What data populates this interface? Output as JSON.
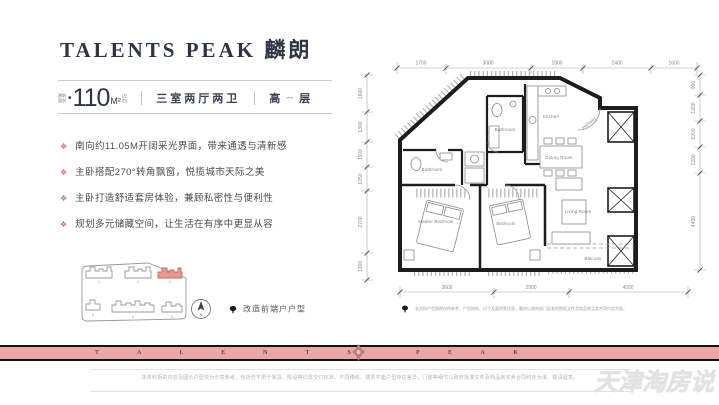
{
  "header": {
    "title": "TALENTS PEAK 麟朗"
  },
  "spec": {
    "area_label_top": "建筑",
    "area_label_bottom": "面积",
    "area_value": "110",
    "area_unit": "M²",
    "area_note_top": "(左",
    "area_note_bottom": "右)",
    "rooms": "三室两厅两卫",
    "floor_prefix": "高",
    "floor_dash": "⁓",
    "floor_suffix": "层"
  },
  "features": [
    "南向约11.05M开阔采光界面，带来通透与清新感",
    "主卧搭配270°转角飘窗，悦揽城市天际之美",
    "主卧打造舒适套房体验，兼顾私密性与便利性",
    "规划多元储藏空间，让生活在有序中更显从容"
  ],
  "siteplan": {
    "legend": "改造前端户户型",
    "compass": "N",
    "buildings": [
      "1",
      "2",
      "3",
      "4",
      "5",
      "6"
    ]
  },
  "floorplan": {
    "rooms": {
      "master": "Master Bedroom",
      "bedroom": "Bedroom",
      "living": "Living Room",
      "balcony": "Balcony",
      "kitchen": "Kitchen",
      "dining": "Dining Room",
      "hallway": "Hallway",
      "bath1": "Bathroom",
      "bath2": "Bathroom"
    },
    "dims_top": [
      "1700",
      "3000",
      "1800",
      "2400",
      "1600"
    ],
    "dims_bottom": [
      "3600",
      "2900",
      "4550"
    ],
    "dims_left": [
      "1600",
      "1300",
      "1100",
      "1050",
      "2700",
      "1200"
    ],
    "dims_right": [
      "900",
      "1200",
      "1200",
      "1200",
      "4450"
    ],
    "note": "本资料户型图例仅供参考，户型结构、尺寸及面积等信息，最终以政府部门批准的图纸文件及商品房买卖合同约定为准。"
  },
  "banner": {
    "letters_left": [
      "T",
      "A",
      "L",
      "E",
      "N",
      "T",
      "S"
    ],
    "letters_right": [
      "P",
      "E",
      "A",
      "K"
    ]
  },
  "footer": {
    "disclaimer": "本资料相关内容及图示户型仅为示意参考，包括但不限于家具、陈设等均非交付标准。不同楼栋、楼层平面户型存在差异，门窗等细节以政府批准文件及商品房买卖合同约定为准，敬请留意。",
    "watermark": "天津淘房说"
  },
  "colors": {
    "title": "#2e3444",
    "accent_pink": "#e9a8a5",
    "bullet_icon": "#c9706c",
    "highlight_building": "#e59a91"
  }
}
